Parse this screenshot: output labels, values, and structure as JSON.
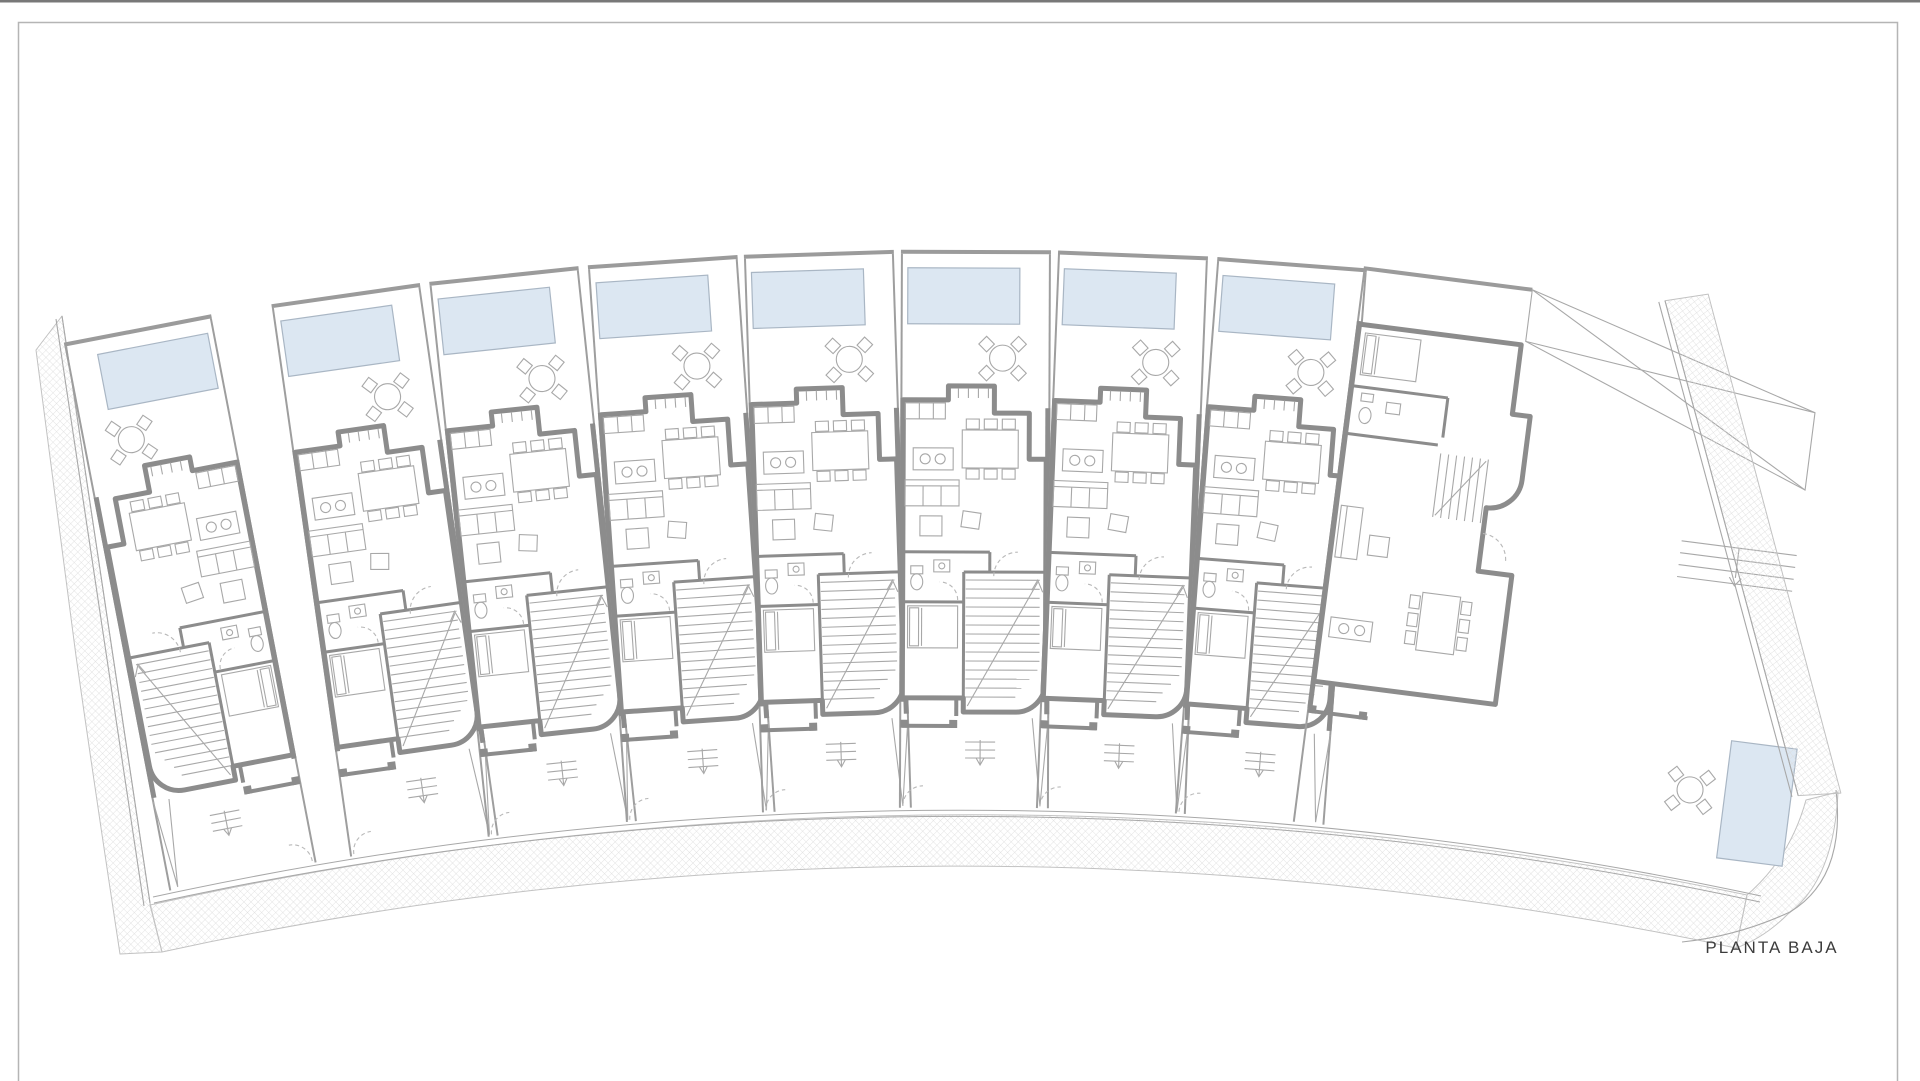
{
  "drawing": {
    "label": "PLANTA BAJA",
    "type": "architectural-ground-floor-plan"
  },
  "site": {
    "units_count": 9,
    "street_side": "bottom",
    "units": [
      {
        "id": "unit-1",
        "variant": "end-left-mirrored",
        "pool": "rear"
      },
      {
        "id": "unit-2",
        "variant": "typical",
        "pool": "rear"
      },
      {
        "id": "unit-3",
        "variant": "typical",
        "pool": "rear"
      },
      {
        "id": "unit-4",
        "variant": "typical",
        "pool": "rear"
      },
      {
        "id": "unit-5",
        "variant": "typical",
        "pool": "rear"
      },
      {
        "id": "unit-6",
        "variant": "typical",
        "pool": "rear"
      },
      {
        "id": "unit-7",
        "variant": "typical",
        "pool": "rear"
      },
      {
        "id": "unit-8",
        "variant": "typical",
        "pool": "rear"
      },
      {
        "id": "unit-9",
        "variant": "corner-end-right",
        "pool": "side-garden"
      }
    ],
    "unit_features": [
      "rear garden with pool",
      "terrace table with four chairs",
      "open-plan kitchen and dining",
      "kitchen island",
      "dining table for six",
      "sofa and coffee table",
      "bathroom",
      "ground floor bedroom",
      "staircase with curved wall",
      "entry porch and front yard"
    ]
  },
  "colors": {
    "background": "#ffffff",
    "topbar": "#787878",
    "frame": "#b5b5b5",
    "wall": "#8c8c8c",
    "wall_light": "#9b9b9b",
    "partition": "#9e9e9e",
    "line": "#a8a8a8",
    "dash": "#b8b8b8",
    "pool_fill": "#dce7f2",
    "pool_border": "#a9b6c4",
    "hatch_line": "#dcdcdc",
    "hatch_border": "#c2c2c2",
    "text": "#3c3c3c"
  }
}
